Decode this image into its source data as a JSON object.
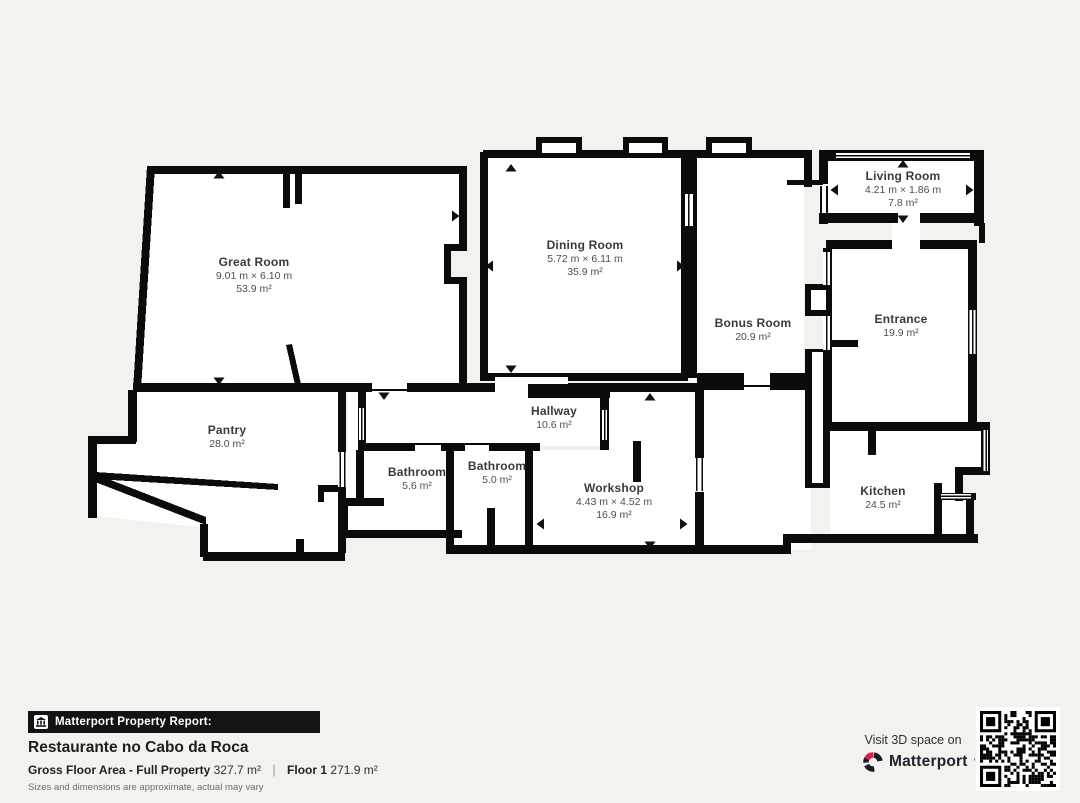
{
  "plan": {
    "rooms": [
      {
        "id": "great-room",
        "name": "Great Room",
        "dims": "9.01 m × 6.10 m",
        "area": "53.9 m²",
        "x": 254,
        "y": 263
      },
      {
        "id": "dining-room",
        "name": "Dining Room",
        "dims": "5.72 m × 6.11 m",
        "area": "35.9 m²",
        "x": 585,
        "y": 246
      },
      {
        "id": "living-room",
        "name": "Living Room",
        "dims": "4.21 m × 1.86 m",
        "area": "7.8 m²",
        "x": 903,
        "y": 177
      },
      {
        "id": "bonus-room",
        "name": "Bonus Room",
        "dims": "",
        "area": "20.9 m²",
        "x": 753,
        "y": 324
      },
      {
        "id": "entrance",
        "name": "Entrance",
        "dims": "",
        "area": "19.9 m²",
        "x": 901,
        "y": 320
      },
      {
        "id": "pantry",
        "name": "Pantry",
        "dims": "",
        "area": "28.0 m²",
        "x": 227,
        "y": 431
      },
      {
        "id": "hallway",
        "name": "Hallway",
        "dims": "",
        "area": "10.6 m²",
        "x": 554,
        "y": 412
      },
      {
        "id": "bathroom-1",
        "name": "Bathroom",
        "dims": "",
        "area": "5.6 m²",
        "x": 417,
        "y": 473
      },
      {
        "id": "bathroom-2",
        "name": "Bathroom",
        "dims": "",
        "area": "5.0 m²",
        "x": 497,
        "y": 467
      },
      {
        "id": "workshop",
        "name": "Workshop",
        "dims": "4.43 m × 4.52 m",
        "area": "16.9 m²",
        "x": 614,
        "y": 489
      },
      {
        "id": "kitchen",
        "name": "Kitchen",
        "dims": "",
        "area": "24.5 m²",
        "x": 883,
        "y": 492
      }
    ]
  },
  "footer": {
    "report_label": "Matterport Property Report:",
    "property_name": "Restaurante no Cabo da Roca",
    "gross_label": "Gross Floor Area - Full Property",
    "gross_value": "327.7 m²",
    "floor_label": "Floor 1",
    "floor_value": "271.9 m²",
    "disclaimer": "Sizes and dimensions are approximate, actual may vary"
  },
  "cta": {
    "visit_label": "Visit 3D space on",
    "brand": "Matterport",
    "brand_mark": "’"
  },
  "colors": {
    "background": "#f3f2ef",
    "wall": "#0b0b0b",
    "floor": "#ffffff",
    "brand_red": "#e11d48",
    "banner_bg": "#131313"
  }
}
